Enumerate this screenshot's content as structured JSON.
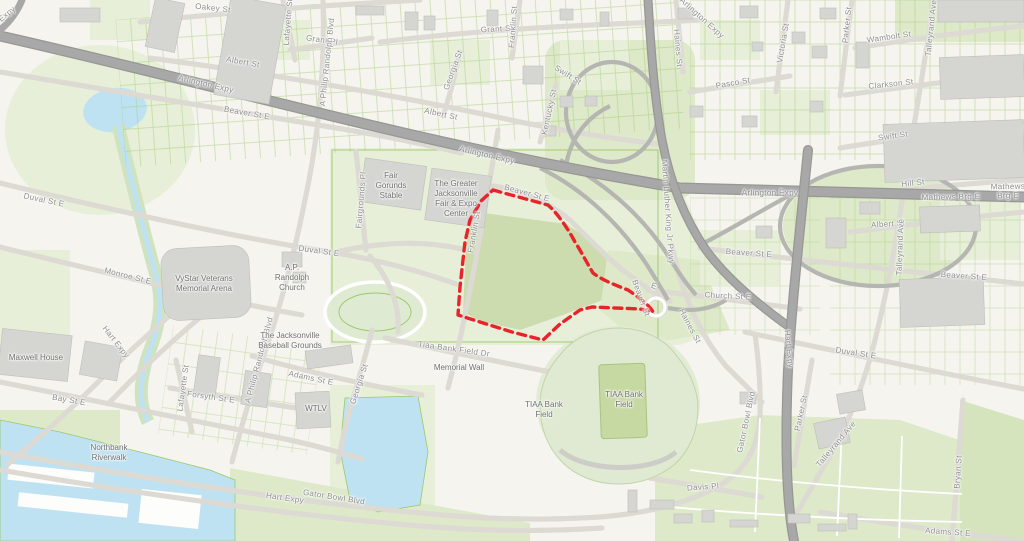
{
  "map": {
    "description": "Street map of the sports-complex and fairgrounds district east of downtown Jacksonville with a red dashed outline highlighting a parcel between Franklin St and the Arlington Expressway interchange",
    "selection_outline": "red-dashed-parcel-boundary"
  },
  "colors": {
    "selection": "#e8232a",
    "water": "#bfe2f2",
    "park": "#e7efd9",
    "park2": "#dde9c9",
    "field": "#ccdcae",
    "building": "#d5d5d1",
    "road_major": "#a8a8a8",
    "road_casing": "#dcdad3",
    "parcel_line": "#9cc768",
    "label_street": "#8d8d8d",
    "label_place": "#6f6f6f"
  },
  "labels": {
    "streets": [
      {
        "text": "Expy",
        "x": 7,
        "y": 14,
        "r": -40
      },
      {
        "text": "Oakey St",
        "x": 213,
        "y": 8,
        "r": 6
      },
      {
        "text": "Grant Pl",
        "x": 322,
        "y": 40,
        "r": 8
      },
      {
        "text": "Grant St",
        "x": 497,
        "y": 29,
        "r": -3
      },
      {
        "text": "Albert St",
        "x": 243,
        "y": 62,
        "r": 10
      },
      {
        "text": "Albert St",
        "x": 441,
        "y": 114,
        "r": 12
      },
      {
        "text": "Albert St",
        "x": 888,
        "y": 224,
        "r": -4
      },
      {
        "text": "Lafayette St",
        "x": 288,
        "y": 22,
        "r": -85
      },
      {
        "text": "Lafayette St",
        "x": 183,
        "y": 388,
        "r": -82
      },
      {
        "text": "A Philip Randolph Blvd",
        "x": 327,
        "y": 62,
        "r": -84
      },
      {
        "text": "A Philip Randolph Blvd",
        "x": 259,
        "y": 360,
        "r": -75
      },
      {
        "text": "Franklin St",
        "x": 513,
        "y": 27,
        "r": -86
      },
      {
        "text": "Franklin St",
        "x": 474,
        "y": 232,
        "r": -80
      },
      {
        "text": "Georgia St",
        "x": 453,
        "y": 70,
        "r": -70
      },
      {
        "text": "Georgia St",
        "x": 359,
        "y": 384,
        "r": -72
      },
      {
        "text": "Kentucky St",
        "x": 549,
        "y": 112,
        "r": -78
      },
      {
        "text": "Swift St",
        "x": 568,
        "y": 75,
        "r": 32
      },
      {
        "text": "Swift St",
        "x": 893,
        "y": 136,
        "r": -8
      },
      {
        "text": "Haines St",
        "x": 678,
        "y": 48,
        "r": 85
      },
      {
        "text": "Haines St",
        "x": 690,
        "y": 326,
        "r": 62
      },
      {
        "text": "Victoria St",
        "x": 783,
        "y": 43,
        "r": -80
      },
      {
        "text": "Parker St",
        "x": 847,
        "y": 25,
        "r": -84
      },
      {
        "text": "Parker St",
        "x": 801,
        "y": 413,
        "r": -78
      },
      {
        "text": "Wambolt St",
        "x": 889,
        "y": 37,
        "r": -8
      },
      {
        "text": "Pasco St",
        "x": 733,
        "y": 83,
        "r": -10
      },
      {
        "text": "Clarkson St",
        "x": 891,
        "y": 84,
        "r": -6
      },
      {
        "text": "Talleyrand Ave",
        "x": 931,
        "y": 28,
        "r": -84
      },
      {
        "text": "Talleyrand Ave",
        "x": 900,
        "y": 247,
        "r": -88
      },
      {
        "text": "Talleyrand Ave",
        "x": 836,
        "y": 444,
        "r": -50
      },
      {
        "text": "Hill St",
        "x": 913,
        "y": 183,
        "r": -6
      },
      {
        "text": "Mathews Brg E",
        "x": 951,
        "y": 197,
        "r": -1
      },
      {
        "text": "Mathews Brg E",
        "x": 1008,
        "y": 191,
        "r": -1
      },
      {
        "text": "Arlington Expy",
        "x": 206,
        "y": 84,
        "r": 13
      },
      {
        "text": "Arlington Expy",
        "x": 487,
        "y": 155,
        "r": 13
      },
      {
        "text": "Arlington Expy",
        "x": 770,
        "y": 193,
        "r": 0
      },
      {
        "text": "Arlington Expy",
        "x": 702,
        "y": 18,
        "r": 42
      },
      {
        "text": "Beaver St E",
        "x": 247,
        "y": 113,
        "r": 10
      },
      {
        "text": "Beaver St E",
        "x": 527,
        "y": 193,
        "r": 15
      },
      {
        "text": "Beaver St E",
        "x": 749,
        "y": 253,
        "r": 4
      },
      {
        "text": "Beaver St E",
        "x": 964,
        "y": 276,
        "r": 4
      },
      {
        "text": "Beaver St",
        "x": 641,
        "y": 298,
        "r": 70
      },
      {
        "text": "E",
        "x": 654,
        "y": 286,
        "r": 20
      },
      {
        "text": "Church St E",
        "x": 728,
        "y": 296,
        "r": 3
      },
      {
        "text": "Duval St E",
        "x": 44,
        "y": 200,
        "r": 12
      },
      {
        "text": "Duval St E",
        "x": 319,
        "y": 251,
        "r": 8
      },
      {
        "text": "Duval St E",
        "x": 856,
        "y": 353,
        "r": 9
      },
      {
        "text": "Monroe St E",
        "x": 128,
        "y": 276,
        "r": 14
      },
      {
        "text": "Martin Luther King Jr Pkwy",
        "x": 668,
        "y": 212,
        "r": 86
      },
      {
        "text": "Fairgrounds Pl",
        "x": 361,
        "y": 200,
        "r": -85
      },
      {
        "text": "Hart Expy",
        "x": 116,
        "y": 342,
        "r": 52
      },
      {
        "text": "Hart Expy",
        "x": 285,
        "y": 498,
        "r": 8
      },
      {
        "text": "Hart Expy",
        "x": 789,
        "y": 349,
        "r": 84
      },
      {
        "text": "Gator Bowl Blvd",
        "x": 334,
        "y": 497,
        "r": 9
      },
      {
        "text": "Gator Bowl Blvd",
        "x": 746,
        "y": 422,
        "r": -78
      },
      {
        "text": "Davis Pl",
        "x": 703,
        "y": 487,
        "r": -4
      },
      {
        "text": "Adams St E",
        "x": 311,
        "y": 378,
        "r": 12
      },
      {
        "text": "Adams St E",
        "x": 948,
        "y": 532,
        "r": 4
      },
      {
        "text": "Forsyth St E",
        "x": 211,
        "y": 397,
        "r": 8
      },
      {
        "text": "Bay St E",
        "x": 69,
        "y": 400,
        "r": 10
      },
      {
        "text": "Tiaa Bank Field Dr",
        "x": 454,
        "y": 349,
        "r": 8
      },
      {
        "text": "Bryan St",
        "x": 958,
        "y": 472,
        "r": -86
      }
    ],
    "places": [
      {
        "text": "Fair\nGorunds\nStable",
        "x": 391,
        "y": 186
      },
      {
        "text": "The Greater\nJacksonville\nFair & Expo\nCenter",
        "x": 456,
        "y": 199
      },
      {
        "text": "VyStar Veterans\nMemorial Arena",
        "x": 204,
        "y": 284
      },
      {
        "text": "A.P.\nRandolph\nChurch",
        "x": 292,
        "y": 278
      },
      {
        "text": "The Jacksonville\nBaseball Grounds",
        "x": 290,
        "y": 341
      },
      {
        "text": "WTLV",
        "x": 316,
        "y": 409
      },
      {
        "text": "Maxwell House",
        "x": 36,
        "y": 358
      },
      {
        "text": "Northbank\nRiverwalk",
        "x": 109,
        "y": 453
      },
      {
        "text": "Memorial Wall",
        "x": 459,
        "y": 368
      },
      {
        "text": "TIAA Bank\nField",
        "x": 544,
        "y": 410
      },
      {
        "text": "TIAA Bank\nField",
        "x": 624,
        "y": 400
      }
    ]
  }
}
